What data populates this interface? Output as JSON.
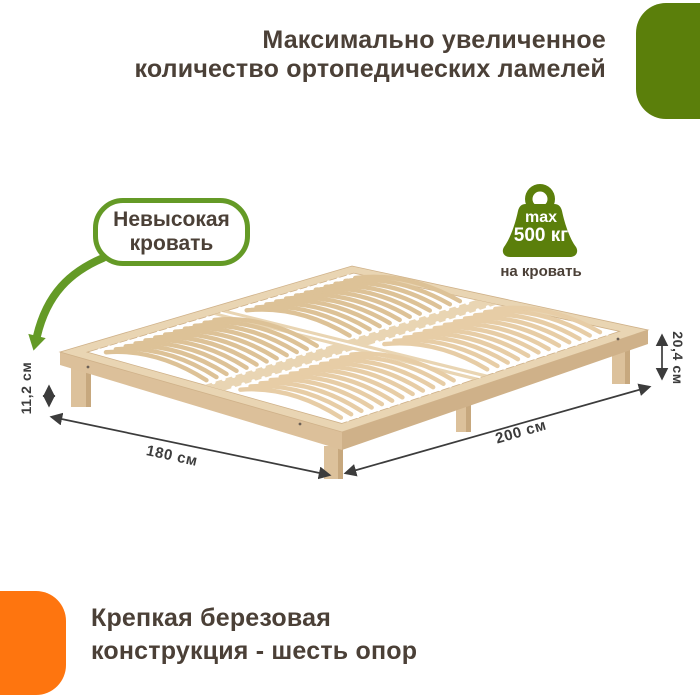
{
  "colors": {
    "green": "#5b7f0b",
    "green_arrow": "#649a26",
    "orange": "#fe750f",
    "heading_text": "#4b4037",
    "dimension_text": "#3c3c3c",
    "wood_rail": "#e9d5b3",
    "wood_rail_side": "#dcc09a",
    "wood_rail_dark": "#cfb189",
    "wood_slat_a": "#e7cda6",
    "wood_slat_b": "#ddc297",
    "wood_leg": "#dcc19b",
    "wood_leg_side": "#c7a87e",
    "holder_white": "#ffffff"
  },
  "header": {
    "line1": "Максимально увеличенное",
    "line2": "количество ортопедических ламелей"
  },
  "callout": {
    "line1": "Невысокая",
    "line2": "кровать"
  },
  "load_badge": {
    "max_label": "max",
    "value": "500 кг",
    "caption": "на кровать"
  },
  "dimensions": {
    "left_height": "11,2 см",
    "right_height": "20,4 см",
    "width": "180 см",
    "length": "200 см"
  },
  "footer": {
    "line1": "Крепкая березовая",
    "line2": "конструкция - шесть опор"
  }
}
